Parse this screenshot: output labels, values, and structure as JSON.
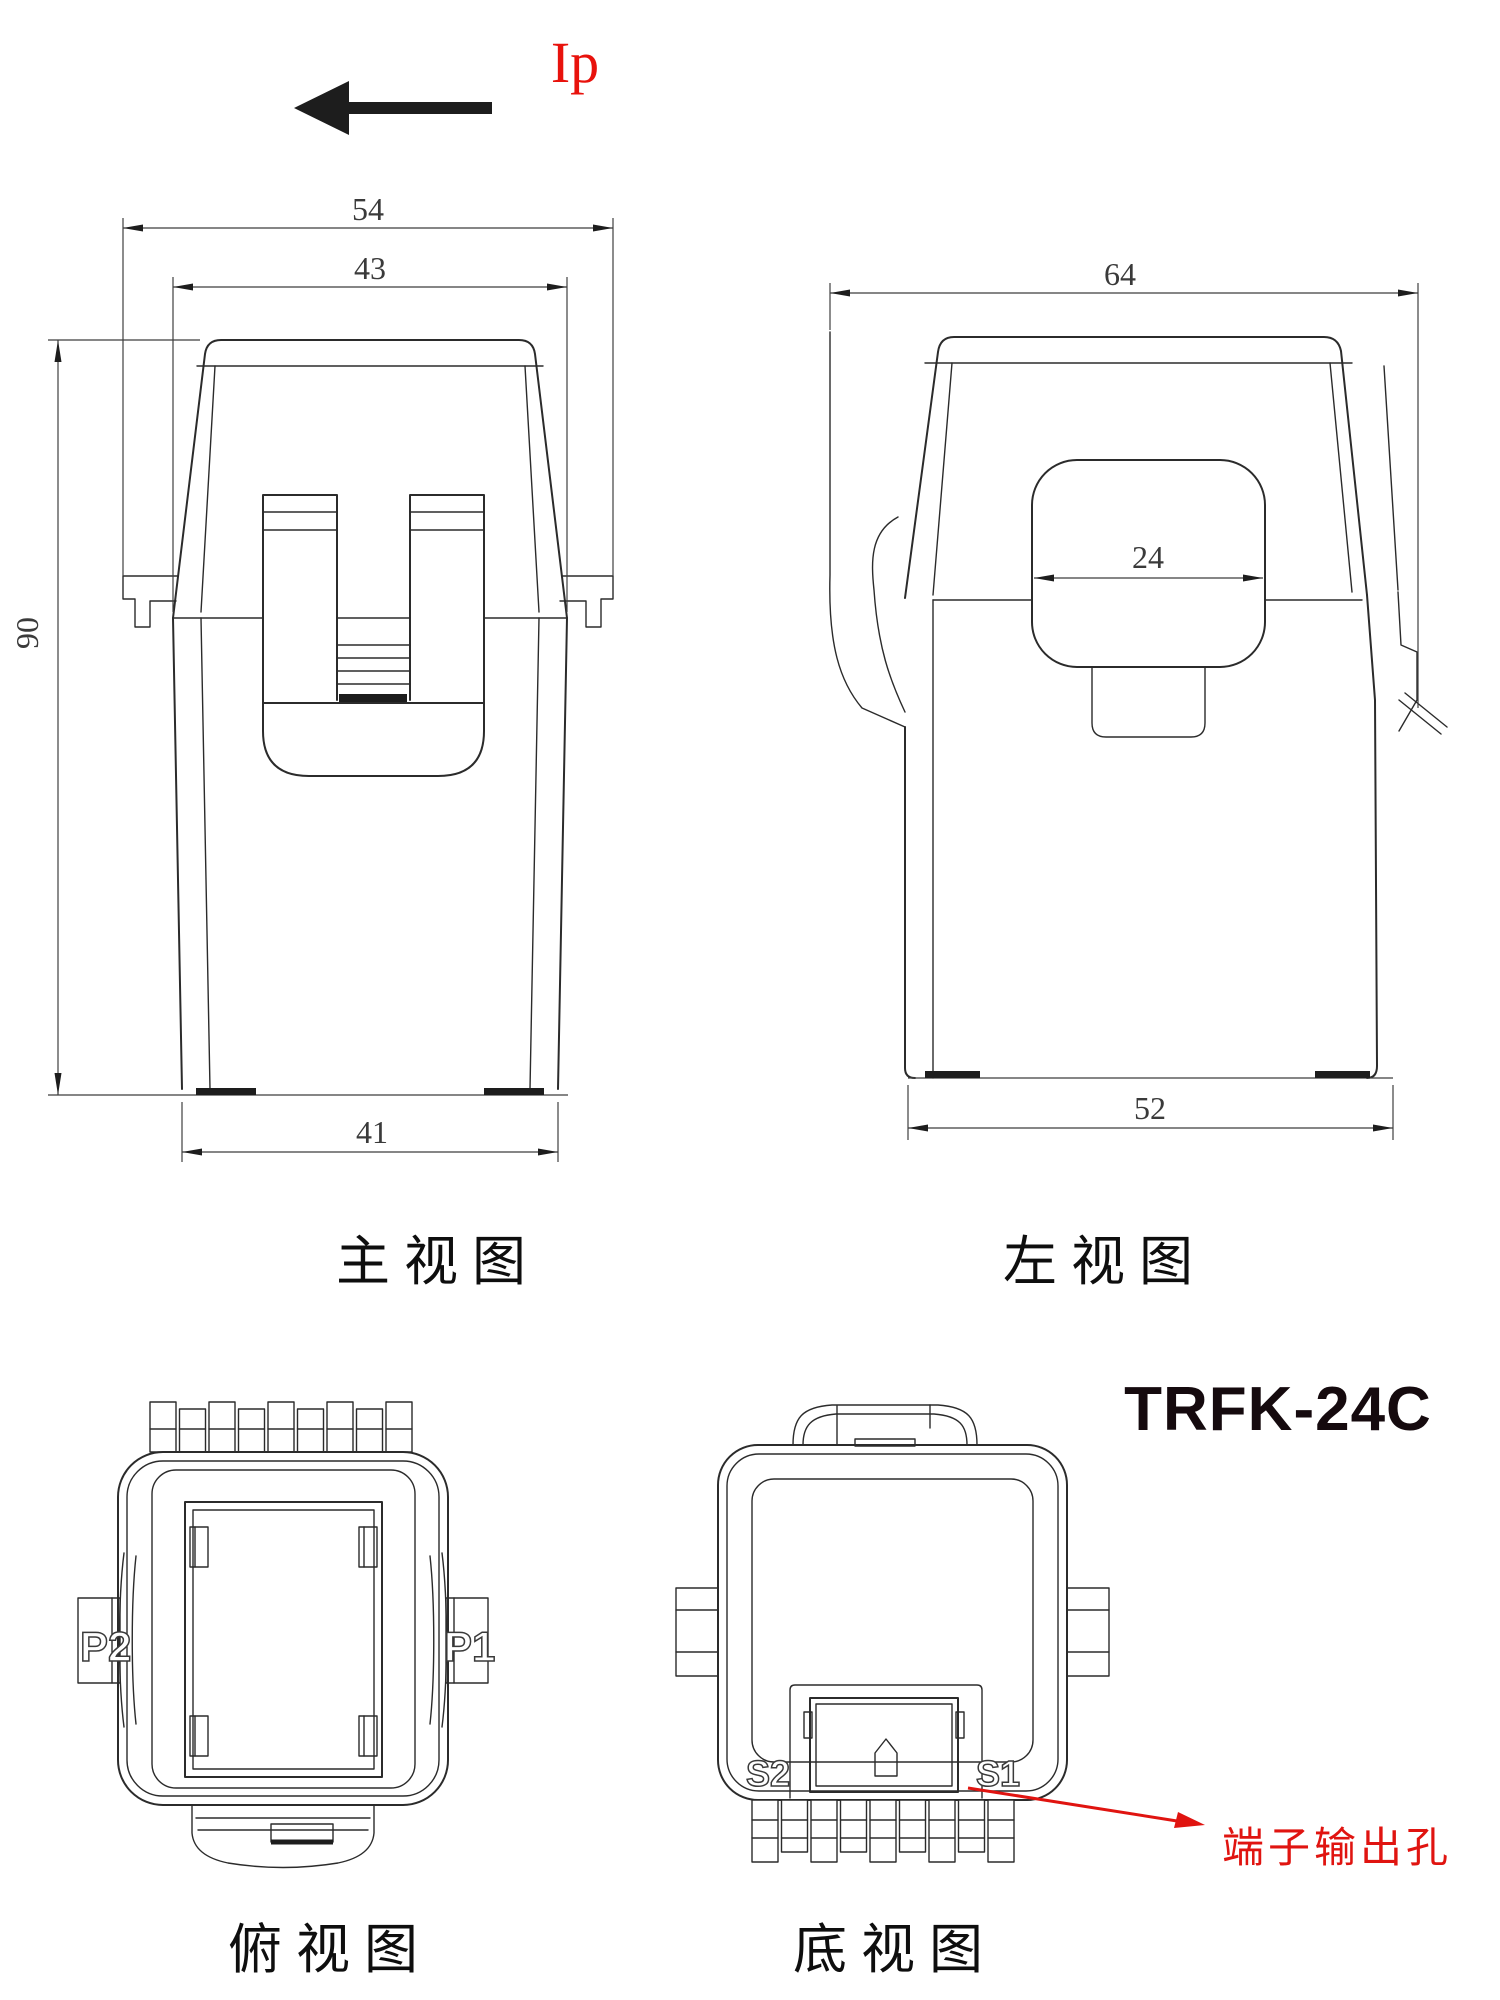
{
  "title": {
    "model": "TRFK-24C"
  },
  "current_flow": {
    "label": "Ip",
    "color": "#e8120c",
    "direction": "left"
  },
  "views": {
    "front": {
      "caption": "主视图",
      "dims": {
        "overall_width": "54",
        "cap_width": "43",
        "height": "90",
        "bottom_width": "41"
      }
    },
    "left": {
      "caption": "左视图",
      "dims": {
        "overall_width": "64",
        "window_width": "24",
        "bottom_width": "52"
      }
    },
    "top": {
      "caption": "俯视图",
      "terminals": {
        "left": "P2",
        "right": "P1"
      }
    },
    "bottom": {
      "caption": "底视图",
      "terminals": {
        "left": "S2",
        "right": "S1"
      },
      "callout": "端子输出孔"
    }
  },
  "colors": {
    "line": "#2b2b2b",
    "dim": "#3f3f3f",
    "accent_red": "#e01410",
    "background": "#ffffff"
  }
}
